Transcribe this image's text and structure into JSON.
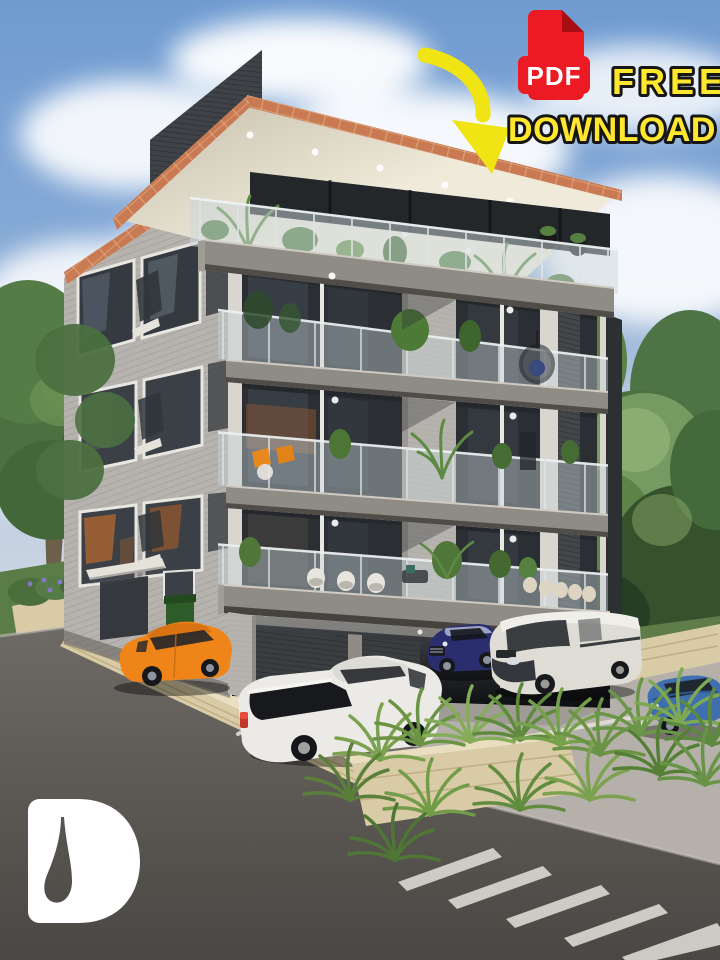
{
  "promo": {
    "pdf_badge": {
      "label": "PDF",
      "icon_color": "#EC1B23",
      "label_color": "#FFFFFF"
    },
    "free_label": "FREE",
    "download_label": "DOWNLOAD",
    "headline_color": "#FFE72E",
    "headline_outline_color": "#161616",
    "arrow_color": "#F0E414"
  },
  "watermark": {
    "letter": "D",
    "color": "#FFFFFF"
  },
  "scene": {
    "subject": "Five-storey modern apartment building exterior render with rooftop terrace, plant-filled balconies, ground-floor parking and street crossing",
    "roof_trim_color": "#C97A52",
    "soffit_color": "#EFEAD9",
    "facade_siding_color": "#B6B3AE",
    "slab_color": "#8F8B85",
    "glass_color": "#2B2F33",
    "pavement_color": "#B5B1AA",
    "road_color": "#6E6A65",
    "stone_wall_color": "#D9CBA6",
    "foliage_color": "#4C7040",
    "vehicles": [
      {
        "name": "orange-hatchback",
        "color": "#EF8418"
      },
      {
        "name": "dark-blue-sedan",
        "color": "#2A2D6E"
      },
      {
        "name": "white-pickup-truck",
        "color": "#ECEAE6"
      },
      {
        "name": "white-van",
        "color": "#DEDCD4"
      },
      {
        "name": "blue-sedan",
        "color": "#3F6FAE"
      }
    ]
  }
}
